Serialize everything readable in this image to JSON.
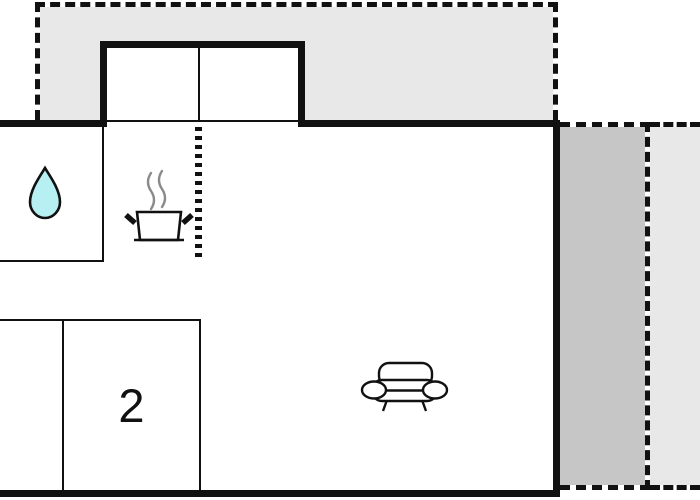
{
  "floorplan": {
    "rooms": {
      "bedroom_label": "2"
    },
    "colors": {
      "wall": "#111111",
      "terrace_light": "#e8e8e8",
      "terrace_dark": "#c6c6c6",
      "water_drop_fill": "#b6f0f2",
      "steam": "#8a8a8a",
      "background": "#ffffff"
    },
    "icons": [
      "water-drop-icon",
      "cooking-pot-icon",
      "steam-icon",
      "sofa-icon"
    ]
  }
}
